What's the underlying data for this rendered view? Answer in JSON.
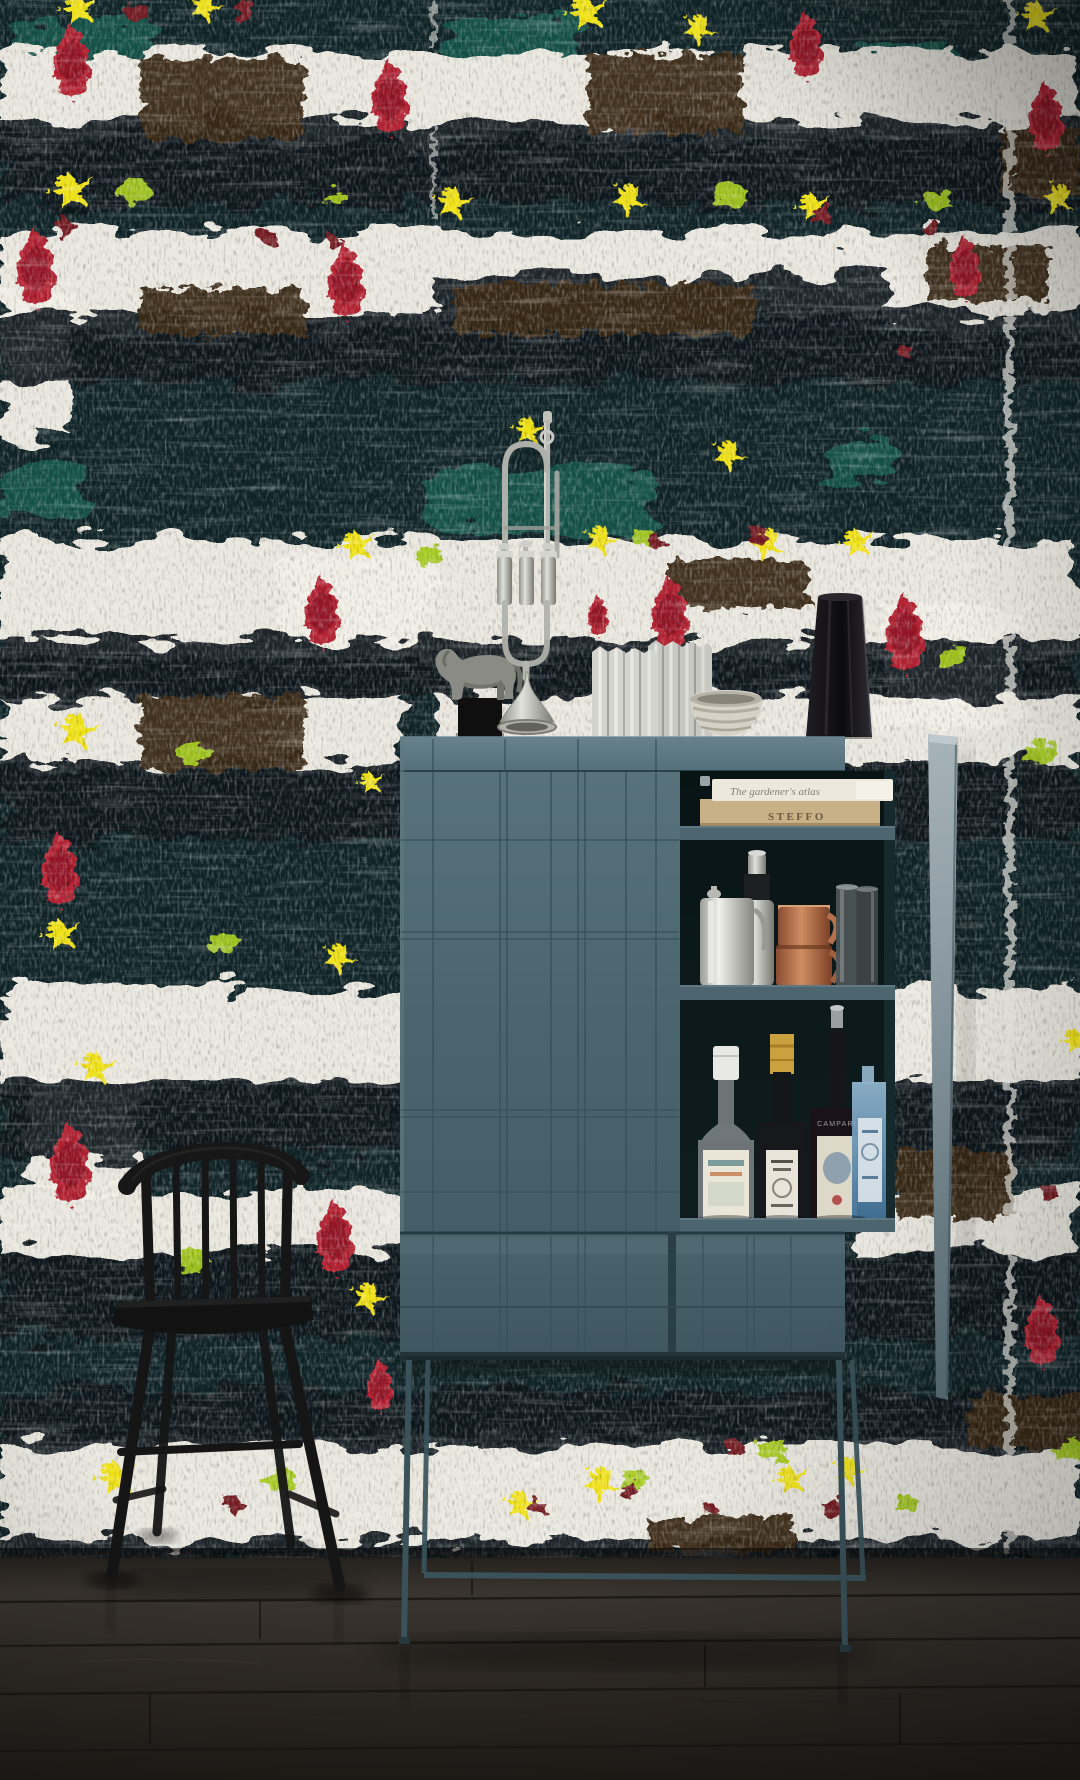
{
  "meta": {
    "scene_type": "interior photograph",
    "width": 1080,
    "height": 1780
  },
  "texts": {
    "book_top": "The gardener's atlas",
    "book_bottom": "STEFFO",
    "campari": "CAMPARI"
  },
  "palette": {
    "wall_base": "#102428",
    "wall_white": "#f2efe6",
    "ink": "#0a171b",
    "brown": "#3b2b18",
    "teal_green": "#16584e",
    "drip_red": "#b32031",
    "drip_dark": "#8c1126",
    "splat_yellow": "#f0e216",
    "blob_green": "#a4ca1e",
    "dot_maroon": "#731d24",
    "cabinet": "#4d6771",
    "cabinet_rail": "#5d7781",
    "cabinet_groove": "#36505a",
    "interior": "#0c1a1c",
    "shelf_edge": "#4c656f",
    "door_edge_light": "#a2b0b6",
    "copper": "#b4714c",
    "silver": "#c6c6c1",
    "glass": "#4e5456",
    "bombay_blue": "#6f9cba",
    "kraft": "#c8b187",
    "cream": "#ece9dc",
    "chair": "#151515",
    "floor_dark": "#221e1a",
    "floor_light": "#3d3731",
    "vase_white": "#d4d4cf",
    "vase_black": "#141217",
    "horse": "#8b8b85"
  },
  "inventory": [
    "abstract brushstroke wallpaper",
    "black windsor chair",
    "teal bar cabinet",
    "silver trumpet",
    "pewter horse figurine",
    "white pleated vases",
    "striped ceramic bowl",
    "black textured vase",
    "stacked cookbooks",
    "cocktail shaker",
    "steel jug",
    "copper mugs",
    "glass tumblers",
    "gin bottle",
    "liqueur bottle",
    "campari bottle",
    "blue gin bottle",
    "dark oak floor"
  ],
  "wallpaper": {
    "bands": [
      [
        0,
        52,
        1080,
        88
      ],
      [
        0,
        232,
        1080,
        100
      ],
      [
        0,
        540,
        1080,
        118
      ],
      [
        285,
        556,
        150,
        104
      ],
      [
        430,
        695,
        650,
        72
      ],
      [
        0,
        692,
        400,
        78
      ],
      [
        880,
        608,
        140,
        118
      ],
      [
        0,
        988,
        1080,
        104
      ],
      [
        30,
        1078,
        115,
        120
      ],
      [
        0,
        1192,
        430,
        62
      ],
      [
        855,
        1192,
        225,
        62
      ],
      [
        0,
        1438,
        1080,
        124
      ],
      [
        0,
        292,
        70,
        145
      ]
    ],
    "inks": [
      [
        0,
        122,
        1080,
        82
      ],
      [
        0,
        315,
        1080,
        68
      ],
      [
        430,
        276,
        452,
        60
      ],
      [
        0,
        640,
        1080,
        58
      ],
      [
        0,
        762,
        1080,
        78
      ],
      [
        0,
        1082,
        1080,
        76
      ],
      [
        0,
        1252,
        1080,
        88
      ],
      [
        0,
        1388,
        1080,
        58
      ],
      [
        0,
        1540,
        1080,
        26
      ]
    ],
    "browns": [
      [
        142,
        58,
        162,
        82
      ],
      [
        588,
        55,
        155,
        78
      ],
      [
        1002,
        128,
        78,
        68
      ],
      [
        140,
        288,
        165,
        46
      ],
      [
        455,
        284,
        300,
        50
      ],
      [
        140,
        695,
        165,
        75
      ],
      [
        668,
        560,
        140,
        48
      ],
      [
        896,
        1148,
        118,
        70
      ],
      [
        648,
        1518,
        145,
        34
      ],
      [
        968,
        1396,
        120,
        52
      ],
      [
        928,
        246,
        120,
        54
      ]
    ],
    "teals": [
      [
        18,
        16,
        132,
        54
      ],
      [
        450,
        18,
        132,
        50
      ],
      [
        0,
        90,
        72,
        46
      ],
      [
        432,
        468,
        222,
        62
      ],
      [
        0,
        460,
        84,
        58
      ],
      [
        822,
        446,
        72,
        38
      ],
      [
        860,
        44,
        96,
        42
      ]
    ],
    "drips": [
      [
        72,
        22,
        1
      ],
      [
        390,
        58,
        1
      ],
      [
        806,
        10,
        0.9
      ],
      [
        1046,
        80,
        0.95
      ],
      [
        36,
        226,
        1.05
      ],
      [
        346,
        242,
        1
      ],
      [
        965,
        234,
        0.85
      ],
      [
        322,
        574,
        0.95
      ],
      [
        598,
        594,
        0.55
      ],
      [
        670,
        574,
        1
      ],
      [
        905,
        592,
        1.05
      ],
      [
        60,
        830,
        1
      ],
      [
        70,
        1120,
        1.1
      ],
      [
        335,
        1198,
        1
      ],
      [
        380,
        1358,
        0.7
      ],
      [
        1042,
        1294,
        0.95
      ]
    ],
    "stars": [
      [
        78,
        8,
        1,
        0
      ],
      [
        204,
        6,
        0.9,
        30
      ],
      [
        586,
        12,
        1.1,
        0
      ],
      [
        698,
        28,
        0.9,
        45
      ],
      [
        1036,
        16,
        1,
        10
      ],
      [
        70,
        190,
        1.15,
        0
      ],
      [
        452,
        202,
        1,
        20
      ],
      [
        628,
        198,
        0.95,
        50
      ],
      [
        812,
        206,
        0.9,
        0
      ],
      [
        1058,
        197,
        0.9,
        70
      ],
      [
        528,
        430,
        0.85,
        15
      ],
      [
        728,
        454,
        0.9,
        40
      ],
      [
        356,
        545,
        0.95,
        0
      ],
      [
        600,
        539,
        0.9,
        30
      ],
      [
        766,
        542,
        0.95,
        60
      ],
      [
        856,
        542,
        0.9,
        0
      ],
      [
        76,
        730,
        1.1,
        20
      ],
      [
        370,
        782,
        0.7,
        0
      ],
      [
        60,
        934,
        1,
        0
      ],
      [
        338,
        957,
        0.9,
        40
      ],
      [
        95,
        1067,
        1,
        15
      ],
      [
        368,
        1297,
        0.95,
        30
      ],
      [
        115,
        1477,
        1.1,
        0
      ],
      [
        520,
        1504,
        0.9,
        20
      ],
      [
        600,
        1482,
        1,
        50
      ],
      [
        790,
        1479,
        0.9,
        0
      ],
      [
        848,
        1470,
        0.85,
        30
      ],
      [
        1075,
        1040,
        0.8,
        0
      ]
    ],
    "greens": [
      [
        134,
        190,
        1
      ],
      [
        338,
        196,
        0.6
      ],
      [
        730,
        194,
        1
      ],
      [
        934,
        200,
        0.9
      ],
      [
        428,
        554,
        0.7
      ],
      [
        646,
        538,
        0.8
      ],
      [
        950,
        657,
        0.85
      ],
      [
        1042,
        752,
        0.85
      ],
      [
        192,
        754,
        0.9
      ],
      [
        225,
        944,
        0.8
      ],
      [
        195,
        1260,
        0.95
      ],
      [
        635,
        1480,
        0.9
      ],
      [
        772,
        1450,
        0.85
      ],
      [
        1070,
        1452,
        0.9
      ],
      [
        908,
        1504,
        0.7
      ],
      [
        282,
        1480,
        0.9
      ]
    ],
    "dots": [
      [
        137,
        12,
        10
      ],
      [
        245,
        10,
        9
      ],
      [
        68,
        228,
        8
      ],
      [
        268,
        236,
        9
      ],
      [
        334,
        242,
        8
      ],
      [
        822,
        214,
        9
      ],
      [
        932,
        228,
        8
      ],
      [
        658,
        542,
        9
      ],
      [
        758,
        536,
        8
      ],
      [
        906,
        352,
        8
      ],
      [
        232,
        1504,
        9
      ],
      [
        538,
        1506,
        8
      ],
      [
        630,
        1488,
        8
      ],
      [
        714,
        1510,
        8
      ],
      [
        734,
        1446,
        8
      ],
      [
        832,
        1508,
        8
      ],
      [
        1048,
        1192,
        9
      ]
    ]
  },
  "cabinet_grooves": {
    "door_v": [
      433,
      500,
      507,
      551,
      578,
      585,
      626,
      656
    ],
    "door_h": [
      840,
      932,
      939,
      1110,
      1117,
      1192
    ],
    "drawer_v_left": [
      433,
      500,
      507,
      551,
      578,
      585,
      626
    ],
    "drawer_v_right": [
      703,
      747,
      754,
      791
    ],
    "rail_v": [
      433,
      505,
      578,
      656
    ]
  },
  "floor": {
    "seams": [
      1598,
      1642,
      1690,
      1747
    ],
    "joints": [
      [
        260,
        1598,
        1642
      ],
      [
        705,
        1642,
        1690
      ],
      [
        472,
        1558,
        1598
      ],
      [
        900,
        1690,
        1747
      ],
      [
        150,
        1690,
        1747
      ]
    ]
  }
}
